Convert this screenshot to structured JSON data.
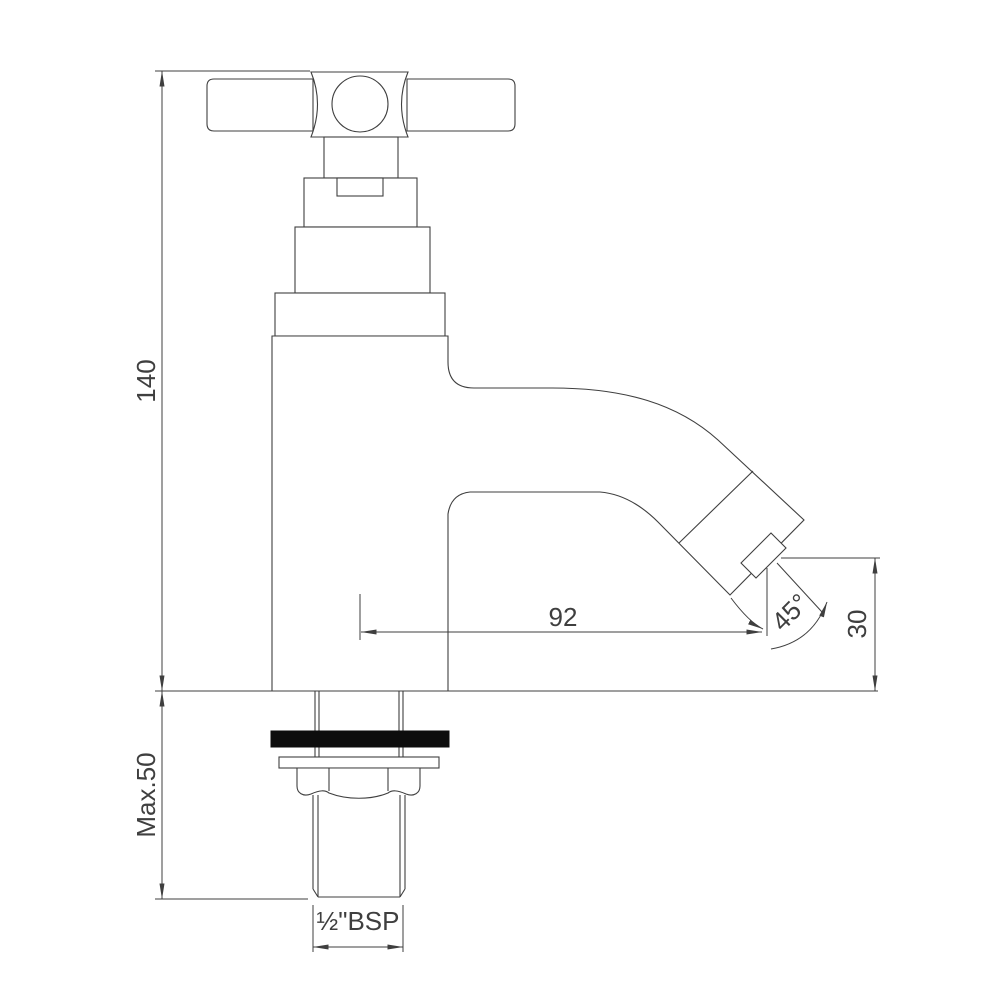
{
  "page": {
    "background": "#ffffff"
  },
  "drawing": {
    "type": "technical-orthographic-drawing",
    "subject": "pillar basin tap with cross handle, 45-degree spout, threaded tail",
    "line_color": "#3f3f3f",
    "washer_color": "#0d0d0d",
    "dimensions": {
      "overall_height": "140",
      "max_mounting_depth": "Max.50",
      "spout_reach": "92",
      "spout_angle": "45°",
      "outlet_height": "30",
      "inlet_thread": "½\"BSP"
    }
  }
}
